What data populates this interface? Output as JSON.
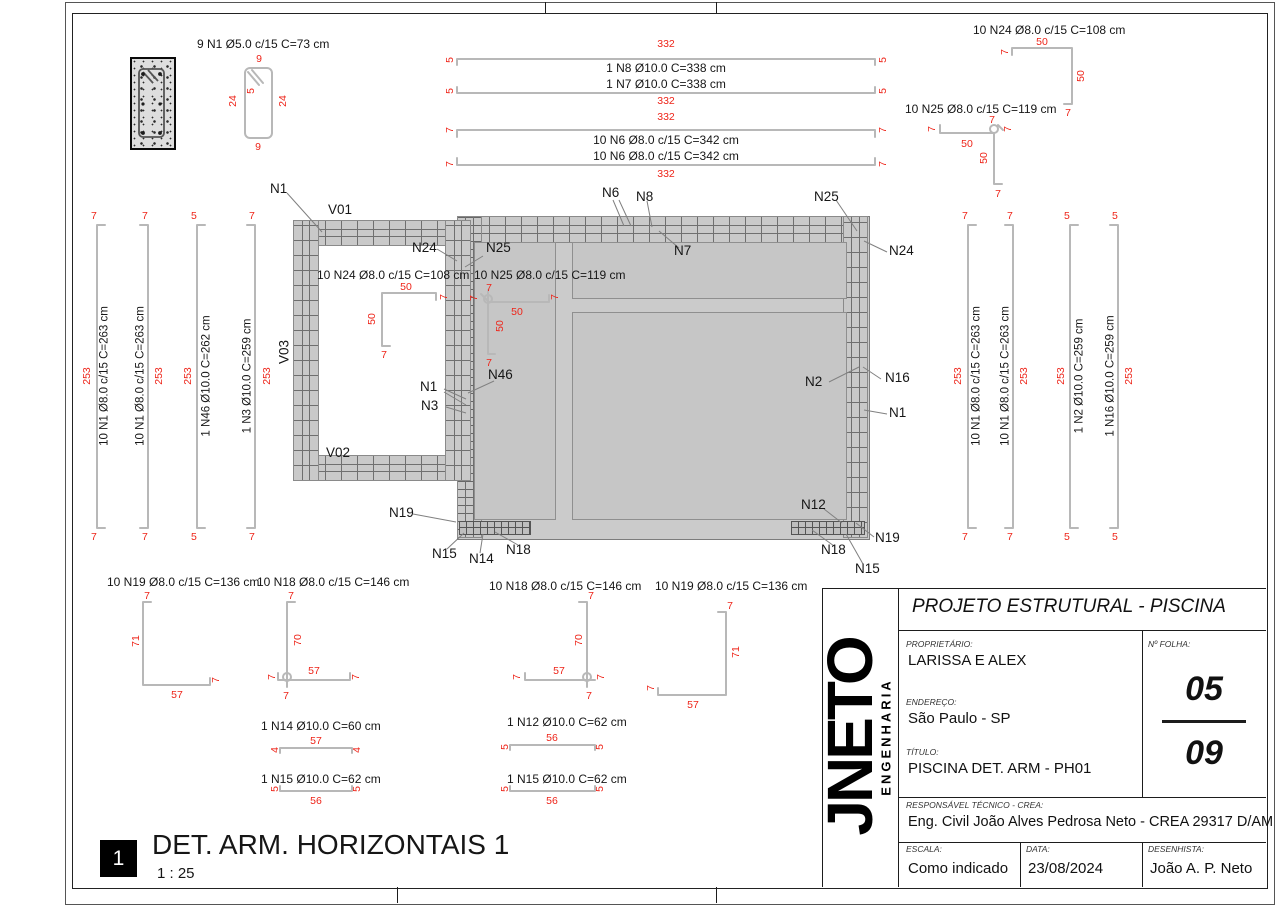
{
  "section": {
    "label": "9 N1 Ø5.0 c/15 C=73 cm",
    "dim_top": "9",
    "dim_left": "24",
    "dim_right": "24",
    "dim_bottom": "9",
    "dim_hook": "5"
  },
  "top_bars": [
    {
      "len": "332",
      "label": "1 N8 Ø10.0 C=338 cm",
      "end_l": "5",
      "end_r": "5"
    },
    {
      "len": "332",
      "label": "1 N7 Ø10.0 C=338 cm",
      "end_l": "5",
      "end_r": "5"
    },
    {
      "len": "332",
      "label": "10 N6 Ø8.0 c/15 C=342 cm",
      "end_l": "7",
      "end_r": "7"
    },
    {
      "len": "332",
      "label": "10 N6 Ø8.0 c/15 C=342 cm",
      "end_l": "7",
      "end_r": "7"
    }
  ],
  "tr_bars": [
    {
      "label": "10 N24 Ø8.0 c/15 C=108 cm",
      "top": "50",
      "side": "50",
      "h1": "7",
      "h2": "7"
    },
    {
      "label": "10 N25 Ø8.0 c/15 C=119 cm",
      "run": "50",
      "drop": "50",
      "h1": "7",
      "h2": "7",
      "h3": "7",
      "h4": "7"
    }
  ],
  "left_bars": [
    {
      "label": "10 N1 Ø8.0 c/15 C=263 cm",
      "len": "253",
      "end_t": "7",
      "end_b": "7"
    },
    {
      "label": "10 N1 Ø8.0 c/15 C=263 cm",
      "len": "253",
      "end_t": "7",
      "end_b": "7"
    },
    {
      "label": "1 N46 Ø10.0 C=262 cm",
      "len": "253",
      "end_t": "5",
      "end_b": "5"
    },
    {
      "label": "1 N3 Ø10.0 C=259 cm",
      "len": "253",
      "end_t": "7",
      "end_b": "7"
    }
  ],
  "right_bars": [
    {
      "label": "10 N1 Ø8.0 c/15 C=263 cm",
      "len": "253",
      "end_t": "7",
      "end_b": "7"
    },
    {
      "label": "10 N1 Ø8.0 c/15 C=263 cm",
      "len": "253",
      "end_t": "7",
      "end_b": "7"
    },
    {
      "label": "1 N2 Ø10.0 C=259 cm",
      "len": "253",
      "end_t": "5",
      "end_b": "5"
    },
    {
      "label": "1 N16 Ø10.0 C=259 cm",
      "len": "253",
      "end_t": "5",
      "end_b": "5"
    }
  ],
  "plan": {
    "beams": {
      "v01": "V01",
      "v02": "V02",
      "v03": "V03"
    },
    "callouts": {
      "n1_tl": "N1",
      "n24_l": "N24",
      "n25_l": "N25",
      "n46": "N46",
      "n1_l": "N1",
      "n3": "N3",
      "n6": "N6",
      "n8": "N8",
      "n7": "N7",
      "n25_tr": "N25",
      "n24_r": "N24",
      "n2": "N2",
      "n16": "N16",
      "n1_r": "N1",
      "n12": "N12",
      "n19_r": "N19",
      "n18_r": "N18",
      "n15_r": "N15",
      "n19_l": "N19",
      "n15_l": "N15",
      "n14": "N14",
      "n18_l": "N18"
    },
    "bar_n24": {
      "label": "10 N24 Ø8.0 c/15 C=108 cm",
      "top": "50",
      "side": "50",
      "h1": "7",
      "h2": "7"
    },
    "bar_n25": {
      "label": "10 N25 Ø8.0 c/15 C=119 cm",
      "run": "50",
      "drop": "50",
      "h1": "7",
      "h2": "7",
      "h3": "7",
      "h4": "7"
    }
  },
  "bottom_bent": [
    {
      "label": "10 N19 Ø8.0 c/15 C=136 cm",
      "v": "71",
      "h": "57",
      "e1": "7",
      "e2": "7"
    },
    {
      "label": "10 N18 Ø8.0 c/15 C=146 cm",
      "v": "70",
      "h": "57",
      "e1": "7",
      "e2": "7",
      "e3": "7",
      "e4": "7"
    },
    {
      "label": "10 N18 Ø8.0 c/15 C=146 cm",
      "v": "70",
      "h": "57",
      "e1": "7",
      "e2": "7",
      "e3": "7",
      "e4": "7"
    },
    {
      "label": "10 N19 Ø8.0 c/15 C=136 cm",
      "v": "71",
      "h": "57",
      "e1": "7",
      "e2": "7"
    }
  ],
  "bottom_straight": [
    {
      "label": "1 N14 Ø10.0 C=60 cm",
      "len": "57",
      "end_l": "4",
      "end_r": "4"
    },
    {
      "label": "1 N15 Ø10.0 C=62 cm",
      "len": "56",
      "end_l": "5",
      "end_r": "5"
    },
    {
      "label": "1 N12 Ø10.0 C=62 cm",
      "len": "56",
      "end_l": "5",
      "end_r": "5"
    },
    {
      "label": "1 N15 Ø10.0 C=62 cm",
      "len": "56",
      "end_l": "5",
      "end_r": "5"
    }
  ],
  "view": {
    "number": "1",
    "title": "DET. ARM. HORIZONTAIS 1",
    "scale": "1 : 25"
  },
  "titleblock": {
    "logo_main": "JNETO",
    "logo_sub": "ENGENHARIA",
    "project_title": "PROJETO ESTRUTURAL - PISCINA",
    "owner_label": "PROPRIETÁRIO:",
    "owner": "LARISSA E ALEX",
    "address_label": "ENDEREÇO:",
    "address": "São Paulo - SP",
    "title_label": "TÍTULO:",
    "title": "PISCINA DET. ARM - PH01",
    "sheet_label": "Nº FOLHA:",
    "sheet_num": "05",
    "sheet_total": "09",
    "resp_label": "RESPONSÁVEL TÉCNICO - CREA:",
    "resp": "Eng. Civil João Alves Pedrosa Neto -  CREA 29317 D/AM",
    "scale_label": "ESCALA:",
    "scale": "Como indicado",
    "date_label": "DATA:",
    "date": "23/08/2024",
    "drafter_label": "DESENHISTA:",
    "drafter": "João A. P. Neto"
  },
  "colors": {
    "dim_red": "#ee2419",
    "bar_gray": "#b8b8b8",
    "slab_fill": "#cbcbcb",
    "hatch_line": "#6f6f6f"
  }
}
